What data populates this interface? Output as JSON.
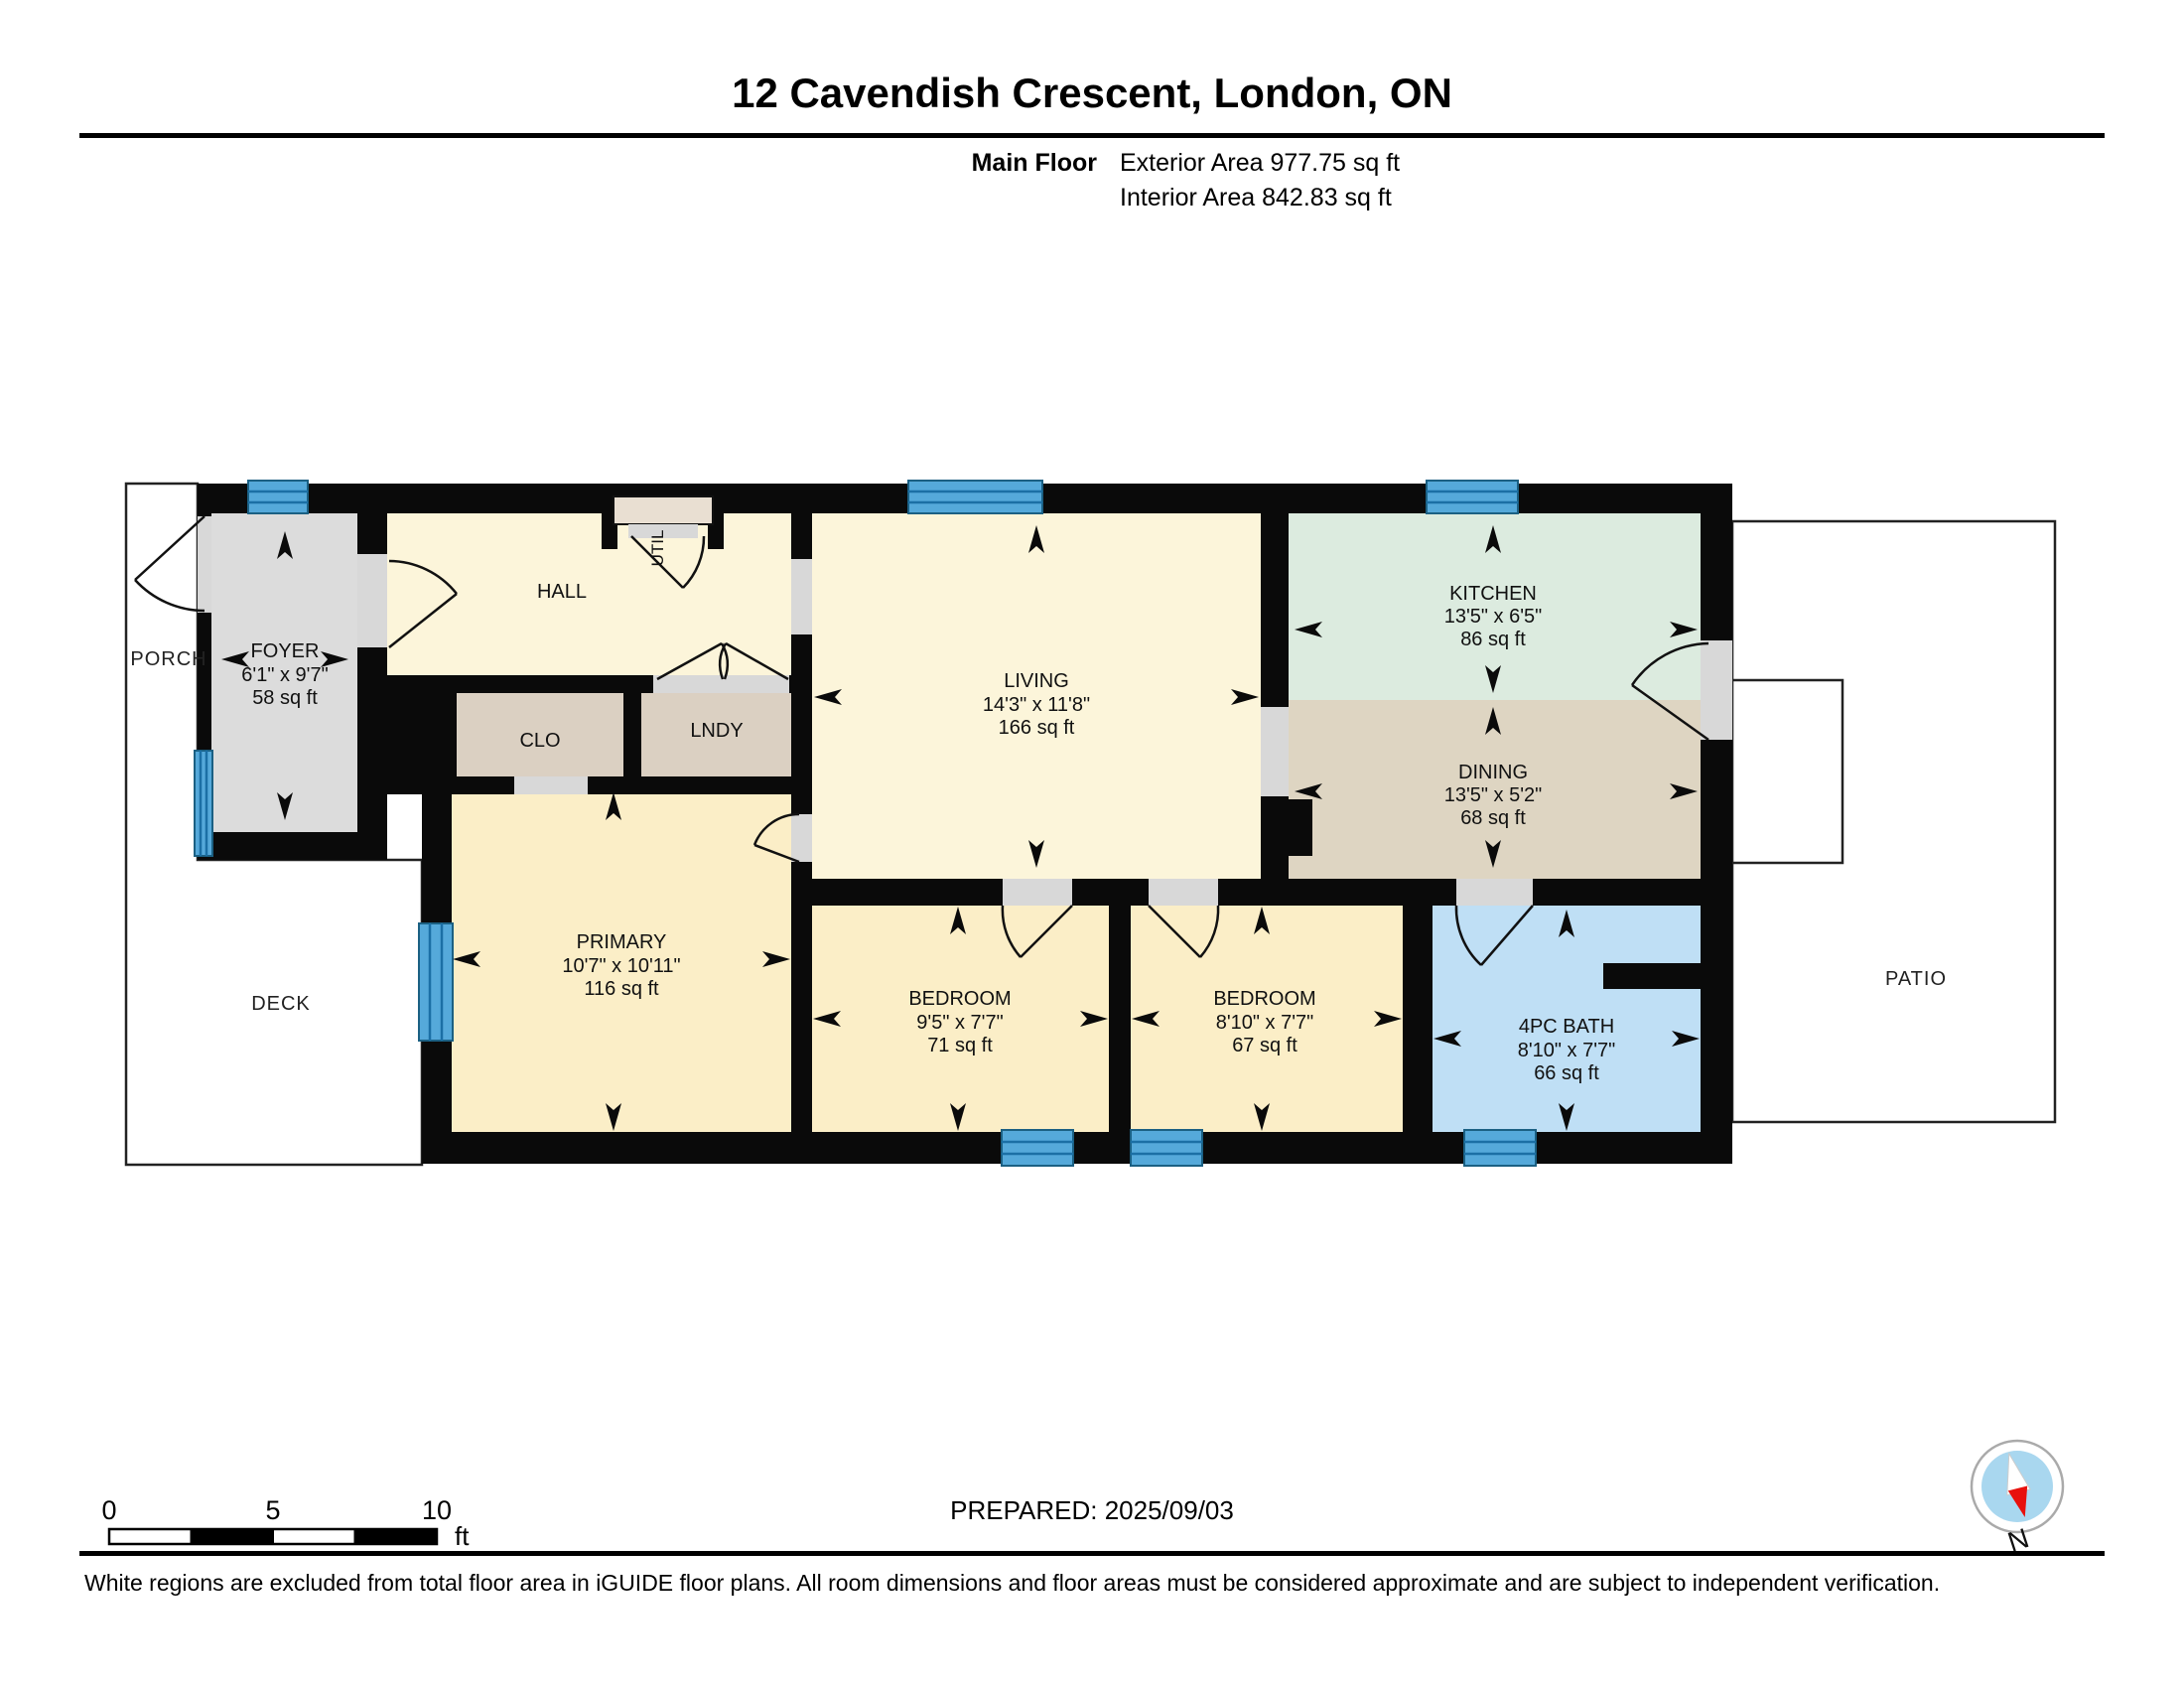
{
  "header": {
    "title": "12 Cavendish Crescent, London, ON",
    "floor_label": "Main Floor",
    "exterior_area": "Exterior Area 977.75 sq ft",
    "interior_area": "Interior Area 842.83 sq ft"
  },
  "rooms": {
    "foyer": {
      "name": "FOYER",
      "dims": "6'1\" x 9'7\"",
      "area": "58 sq ft"
    },
    "hall": {
      "name": "HALL"
    },
    "util": {
      "name": "UTIL"
    },
    "clo": {
      "name": "CLO"
    },
    "lndy": {
      "name": "LNDY"
    },
    "living": {
      "name": "LIVING",
      "dims": "14'3\" x 11'8\"",
      "area": "166 sq ft"
    },
    "kitchen": {
      "name": "KITCHEN",
      "dims": "13'5\" x 6'5\"",
      "area": "86 sq ft"
    },
    "dining": {
      "name": "DINING",
      "dims": "13'5\" x 5'2\"",
      "area": "68 sq ft"
    },
    "primary": {
      "name": "PRIMARY",
      "dims": "10'7\" x 10'11\"",
      "area": "116 sq ft"
    },
    "bedroom1": {
      "name": "BEDROOM",
      "dims": "9'5\" x 7'7\"",
      "area": "71 sq ft"
    },
    "bedroom2": {
      "name": "BEDROOM",
      "dims": "8'10\" x 7'7\"",
      "area": "67 sq ft"
    },
    "bath": {
      "name": "4PC BATH",
      "dims": "8'10\" x 7'7\"",
      "area": "66 sq ft"
    }
  },
  "outdoor": {
    "porch": "PORCH",
    "deck": "DECK",
    "patio": "PATIO"
  },
  "scale_bar": {
    "tick_0": "0",
    "tick_5": "5",
    "tick_10": "10",
    "unit": "ft"
  },
  "footer": {
    "prepared": "PREPARED: 2025/09/03",
    "disclaimer": "White regions are excluded from total floor area in iGUIDE floor plans. All room dimensions and floor areas must be considered approximate and are subject to independent verification.",
    "compass_label": "N"
  },
  "colors": {
    "wall": "#0a0a0a",
    "window": "#55a9da",
    "room_cream": "#fcf5da",
    "room_warm": "#fbeec7",
    "kitchen": "#dcebdf",
    "dining": "#ded5c2",
    "bath": "#bfdff5",
    "foyer": "#dcdcdc",
    "closet": "#dbd0c2",
    "opening": "#d8d8d8",
    "compass_red": "#e8100c"
  }
}
